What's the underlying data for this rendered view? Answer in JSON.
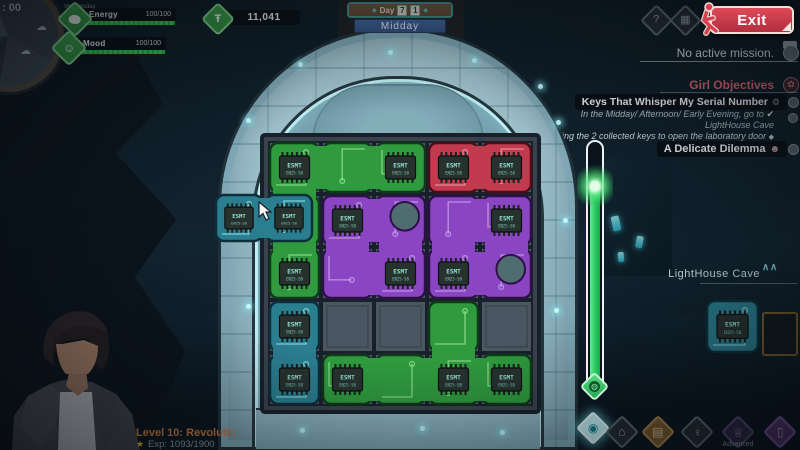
{
  "hud": {
    "time_label": ": 00",
    "weekday": "Wednesday",
    "energy": {
      "label": "Energy",
      "value": "100/100"
    },
    "mood": {
      "label": "Mood",
      "value": "100/100"
    },
    "currency": {
      "value": "11,041"
    },
    "day_sign": {
      "day_label": "Day",
      "day_digits": [
        "7",
        "1"
      ],
      "time_of_day": "Midday"
    },
    "exit_label": "Exit"
  },
  "right_panel": {
    "mission_status": "No active mission.",
    "girl_objectives_title": "Girl Objectives",
    "objective1": {
      "title": "Keys That Whisper My Serial Number",
      "detail_line1": "In the Midday/ Afternoon/ Early Evening, go to",
      "detail_line2": "LightHouse Cave",
      "detail2": "Bring the 2 collected keys to open the laboratory door"
    },
    "objective2": {
      "title": "A Delicate Dilemma"
    },
    "location_panel": {
      "title": "LightHouse Cave"
    }
  },
  "player": {
    "level_text": "Level 10: Revolutic",
    "exp_text": "Exp: 1093/1900"
  },
  "bottom_bar": {
    "advanced_label": "Advanced"
  },
  "icons": {
    "question": "?",
    "grid": "▦",
    "home": "⌂",
    "spiral": "◉",
    "inventory": "▤",
    "girl": "♀",
    "advanced": "♕",
    "phone": "▯",
    "check": "✔",
    "diamond_bullet": "◆",
    "flower": "✿",
    "gear": "⚙",
    "person": "☻",
    "chevron": "∧",
    "star": "★",
    "currency": "Ŧ",
    "mood": "☺",
    "cloud": "☁",
    "gem_core": "◍"
  },
  "puzzle": {
    "chip": {
      "label": "ESMT",
      "sub": "EN25-S8",
      "body": "#27322f",
      "pin": "#18211e",
      "text": "#8fe0cf"
    },
    "palette": {
      "green": {
        "base": "#2f9b3e",
        "dark": "#0f3a1a",
        "trace": "#90e090",
        "light": "#56c268"
      },
      "red": {
        "base": "#c23a4e",
        "dark": "#4a0e1a",
        "trace": "#f09aa4",
        "light": "#d86a78"
      },
      "purple": {
        "base": "#8a46c2",
        "dark": "#2e1048",
        "trace": "#c8a0ea",
        "light": "#a86fd8"
      },
      "teal": {
        "base": "#2b7e90",
        "dark": "#0c2f3a",
        "trace": "#8fdce6",
        "light": "#4aa8b8"
      }
    },
    "grid": {
      "cols": 5,
      "rows": 5,
      "empty": "#4a5662",
      "line": "#18212b",
      "bg": "#3a434d",
      "pad": "#4f6d70"
    },
    "pieces": [
      {
        "id": "green-L",
        "color": "green",
        "cells": [
          [
            0,
            0
          ],
          [
            1,
            0
          ],
          [
            2,
            0
          ],
          [
            0,
            1
          ],
          [
            0,
            2
          ]
        ],
        "chips": [
          [
            0,
            0
          ],
          [
            2,
            0
          ],
          [
            0,
            2
          ]
        ],
        "pads": []
      },
      {
        "id": "red-bar",
        "color": "red",
        "cells": [
          [
            3,
            0
          ],
          [
            4,
            0
          ]
        ],
        "chips": [
          [
            3,
            0
          ],
          [
            4,
            0
          ]
        ],
        "pads": []
      },
      {
        "id": "purple-left",
        "color": "purple",
        "cells": [
          [
            1,
            1
          ],
          [
            2,
            1
          ],
          [
            1,
            2
          ],
          [
            2,
            2
          ]
        ],
        "chips": [
          [
            1,
            1
          ],
          [
            2,
            2
          ]
        ],
        "pads": [
          [
            2,
            1
          ]
        ]
      },
      {
        "id": "purple-right",
        "color": "purple",
        "cells": [
          [
            3,
            1
          ],
          [
            4,
            1
          ],
          [
            3,
            2
          ],
          [
            4,
            2
          ]
        ],
        "chips": [
          [
            4,
            1
          ],
          [
            3,
            2
          ]
        ],
        "pads": [
          [
            4,
            2
          ]
        ]
      },
      {
        "id": "teal-bar",
        "color": "teal",
        "cells": [
          [
            0,
            3
          ],
          [
            0,
            4
          ]
        ],
        "chips": [
          [
            0,
            3
          ],
          [
            0,
            4
          ]
        ],
        "pads": []
      },
      {
        "id": "green-T",
        "color": "green",
        "cells": [
          [
            3,
            3
          ],
          [
            1,
            4
          ],
          [
            2,
            4
          ],
          [
            3,
            4
          ],
          [
            4,
            4
          ]
        ],
        "chips": [
          [
            1,
            4
          ],
          [
            3,
            4
          ],
          [
            4,
            4
          ]
        ],
        "pads": []
      }
    ],
    "empty_cells": [
      [
        1,
        3
      ],
      [
        2,
        3
      ],
      [
        4,
        3
      ]
    ],
    "dragged_piece": {
      "id": "dragged",
      "color": "teal",
      "cells": [
        [
          0,
          0
        ],
        [
          1,
          0
        ]
      ],
      "chips": [
        [
          0,
          0
        ],
        [
          1,
          0
        ]
      ],
      "pads": []
    },
    "inventory_piece": {
      "id": "inventory",
      "color": "teal",
      "cells": [
        [
          0,
          0
        ]
      ],
      "chips": [
        [
          0,
          0
        ]
      ],
      "pads": []
    }
  }
}
